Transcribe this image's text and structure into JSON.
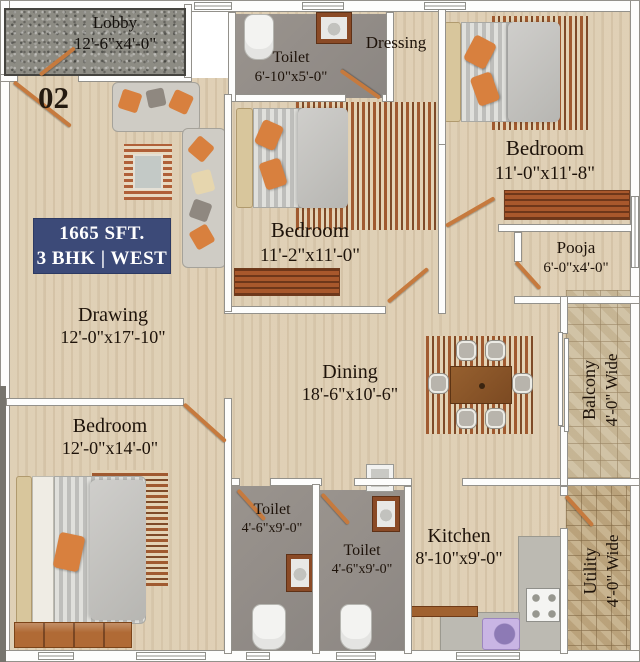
{
  "plan": {
    "unit_number": "02",
    "badge": {
      "area": "1665 SFT.",
      "config": "3 BHK | WEST"
    },
    "rooms": {
      "lobby": {
        "name": "Lobby",
        "dims": "12'-6\"x4'-0\""
      },
      "toilet_top": {
        "name": "Toilet",
        "dims": "6'-10\"x5'-0\""
      },
      "dressing": {
        "name": "Dressing",
        "dims": ""
      },
      "bedroom_right": {
        "name": "Bedroom",
        "dims": "11'-0\"x11'-8\""
      },
      "pooja": {
        "name": "Pooja",
        "dims": "6'-0\"x4'-0\""
      },
      "bedroom_middle": {
        "name": "Bedroom",
        "dims": "11'-2\"x11'-0\""
      },
      "drawing": {
        "name": "Drawing",
        "dims": "12'-0\"x17'-10\""
      },
      "dining": {
        "name": "Dining",
        "dims": "18'-6\"x10'-6\""
      },
      "balcony": {
        "name": "Balcony",
        "dims": "4'-0\" Wide"
      },
      "bedroom_left": {
        "name": "Bedroom",
        "dims": "12'-0\"x14'-0\""
      },
      "toilet_left": {
        "name": "Toilet",
        "dims": "4'-6\"x9'-0\""
      },
      "toilet_middle": {
        "name": "Toilet",
        "dims": "4'-6\"x9'-0\""
      },
      "kitchen": {
        "name": "Kitchen",
        "dims": "8'-10\"x9'-0\""
      },
      "utility": {
        "name": "Utility",
        "dims": "4'-0\" Wide"
      }
    },
    "colors": {
      "badge_bg": "#3c4a78",
      "badge_text": "#ffffff",
      "label_text": "#1e130a",
      "wood_floor": "#e9dcc3",
      "toilet_floor": "#95908a",
      "lobby_granite": "#8d8c84",
      "balcony_tile": "#ccbc9c",
      "utility_tile": "#c2ab83",
      "door_leaf": "#c67a3e",
      "kitchen_sink": "#c9b5e4"
    }
  }
}
